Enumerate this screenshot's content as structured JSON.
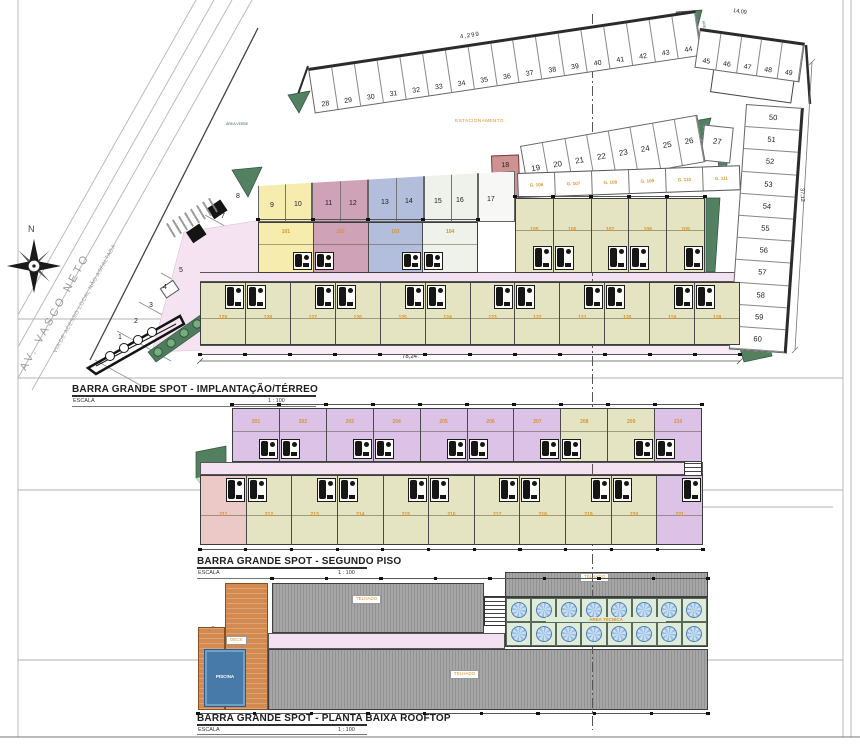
{
  "compass": {
    "north_label": "N"
  },
  "roads": {
    "main": "AV. VASCO NETO",
    "secondary": "VIA DE ACESSO LOCAL NÃO ASFALTADA"
  },
  "dimensions": {
    "top": "4,299",
    "top_right": "14,09",
    "right": "37,12",
    "bottom": "78,24"
  },
  "site_labels": {
    "parking": "ESTACIONAMENTO",
    "green": "ÁREA VERDE"
  },
  "lots": {
    "top": [
      "28",
      "29",
      "30",
      "31",
      "32",
      "33",
      "34",
      "35",
      "36",
      "37",
      "38",
      "39",
      "40",
      "41",
      "42",
      "43",
      "44"
    ],
    "top_right": [
      "45",
      "46",
      "47",
      "48",
      "49"
    ],
    "right": [
      "50",
      "51",
      "52",
      "53",
      "54",
      "55",
      "56",
      "57",
      "58",
      "59",
      "60"
    ],
    "middle": [
      "19",
      "20",
      "21",
      "22",
      "23",
      "24",
      "25",
      "26"
    ],
    "lot_27": "27",
    "lot_18": "18",
    "left": [
      "1",
      "2",
      "3",
      "4",
      "5"
    ],
    "parking": [
      "7",
      "8"
    ],
    "colored": [
      {
        "nums": [
          "9",
          "10"
        ],
        "color": "#f6ecae"
      },
      {
        "nums": [
          "11",
          "12"
        ],
        "color": "#d0a2b8"
      },
      {
        "nums": [
          "13",
          "14"
        ],
        "color": "#b2bedc"
      },
      {
        "nums": [
          "15",
          "16"
        ],
        "color": "#eef2ea"
      },
      {
        "nums": [
          "17"
        ],
        "color": "#f7f8f5"
      }
    ]
  },
  "garages": [
    "G. 106",
    "G. 107",
    "G. 108",
    "G. 109",
    "G. 110",
    "G. 111"
  ],
  "plans": [
    {
      "id": "terreo",
      "title": "BARRA GRANDE SPOT - IMPLANTAÇÃO/TÉRREO",
      "escala_label": "ESCALA",
      "escala": "1 : 100"
    },
    {
      "id": "segundo",
      "title": "BARRA GRANDE SPOT - SEGUNDO PISO",
      "escala_label": "ESCALA",
      "escala": "1 : 100"
    },
    {
      "id": "rooftop",
      "title": "BARRA GRANDE SPOT - PLANTA BAIXA ROOFTOP",
      "escala_label": "ESCALA",
      "escala": "1 : 100"
    }
  ],
  "units": {
    "ground_colored": [
      "101",
      "102",
      "103",
      "104"
    ],
    "ground_upper": [
      "105",
      "106",
      "107",
      "108",
      "109"
    ],
    "ground_lower": [
      "129",
      "128",
      "127",
      "126",
      "125",
      "124",
      "123",
      "122",
      "121",
      "120",
      "119",
      "118"
    ],
    "second_upper": [
      "201",
      "202",
      "203",
      "204",
      "205",
      "206",
      "207",
      "208",
      "209",
      "210"
    ],
    "second_lower": [
      "211",
      "212",
      "213",
      "214",
      "215",
      "216",
      "217",
      "218",
      "219",
      "220",
      "221"
    ]
  },
  "rooftop": {
    "deck_label": "DECK",
    "pool_label": "PISCINA",
    "tech_label": "ÁREA TÉCNICA",
    "roof_label": "TELHADO"
  },
  "colors": {
    "olive": "#e4e4c2",
    "lavender": "#dcc2e6",
    "salmon": "#eac9c6",
    "corridor_pink": "#f3e0f0",
    "green_area": "#538060",
    "deck_orange": "#d28a50",
    "pool_blue": "#477aa9",
    "roof_gray": "#9c9c9c",
    "unit_number_orange": "#d8932c"
  }
}
